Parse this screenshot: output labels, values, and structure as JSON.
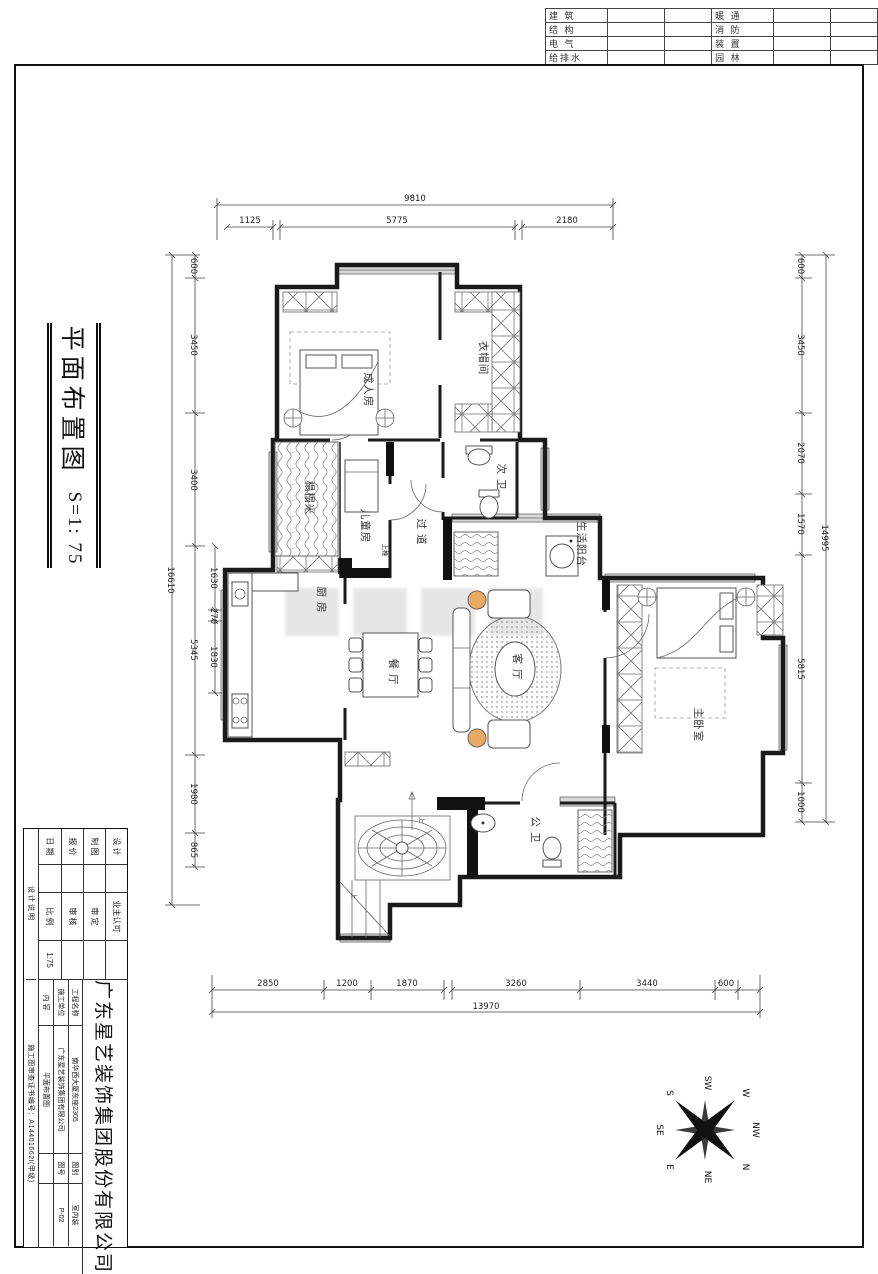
{
  "disciplines": {
    "l1": "建 筑",
    "l2": "结 构",
    "l3": "电 气",
    "l4": "给排水",
    "r1": "暖 通",
    "r2": "消 防",
    "r3": "装 置",
    "r4": "园 林"
  },
  "side_title": {
    "title": "平面布置图",
    "scale": "S=1: 75"
  },
  "title_block": {
    "company": "广东星艺装饰集团股份有限公司",
    "col1": [
      {
        "l": "设 计",
        "v": ""
      },
      {
        "l": "制 图",
        "v": ""
      },
      {
        "l": "报 价",
        "v": ""
      },
      {
        "l": "日 期",
        "v": ""
      }
    ],
    "col2": [
      {
        "l": "业主认可",
        "v": ""
      },
      {
        "l": "审 定",
        "v": ""
      },
      {
        "l": "审 核",
        "v": ""
      },
      {
        "l": "比 例",
        "v": "1:75"
      }
    ],
    "rows": [
      {
        "l": "工程名称",
        "v": "南华西大厦东座2305",
        "l2": "图别",
        "v2": "室内装"
      },
      {
        "l": "施工单位",
        "v": "广东星艺装饰集团有限公司",
        "l2": "图号",
        "v2": "P-02"
      },
      {
        "l": "内 容",
        "v": "平面布置图",
        "l2": "",
        "v2": ""
      }
    ],
    "notes_label": "设计说明",
    "cert": "施工图审查证书编号：A14401662I(甲级)"
  },
  "compass": {
    "n": "N",
    "ne": "NE",
    "e": "E",
    "se": "SE",
    "s": "S",
    "sw": "SW",
    "w": "W",
    "nw": "NW"
  },
  "plan": {
    "rooms": {
      "adult_bedroom": "成人房",
      "cloakroom": "衣帽间",
      "tatami": "榻榻米",
      "kids_room": "儿童房",
      "second_bath": "次 卫",
      "corridor": "过 道",
      "service_balcony": "生活阳台",
      "kitchen": "厨 房",
      "dining": "餐 厅",
      "living": "客 厅",
      "master_bedroom": "主卧室",
      "public_bath": "公 卫"
    },
    "annotations": {
      "up1": "上",
      "up2": "上",
      "slide": "上推"
    },
    "dims": {
      "top": {
        "overall": "9810",
        "s1": "1125",
        "s2": "5775",
        "s3": "2180"
      },
      "bottom": {
        "overall": "13970",
        "s1": "2850",
        "s2": "1200",
        "s3": "1870",
        "s4": "3260",
        "s5": "3440",
        "s6": "600"
      },
      "left": {
        "overall": "16610",
        "s1": "600",
        "s2": "3450",
        "s3": "3400",
        "s4": "5345",
        "s5": "1980",
        "s6": "865",
        "i1": "1630",
        "i2": "270",
        "i3": "1830"
      },
      "right": {
        "overall": "14995",
        "s1": "600",
        "s2": "3450",
        "s3": "2070",
        "s4": "1570",
        "s5": "5815",
        "s6": "1000"
      }
    }
  }
}
